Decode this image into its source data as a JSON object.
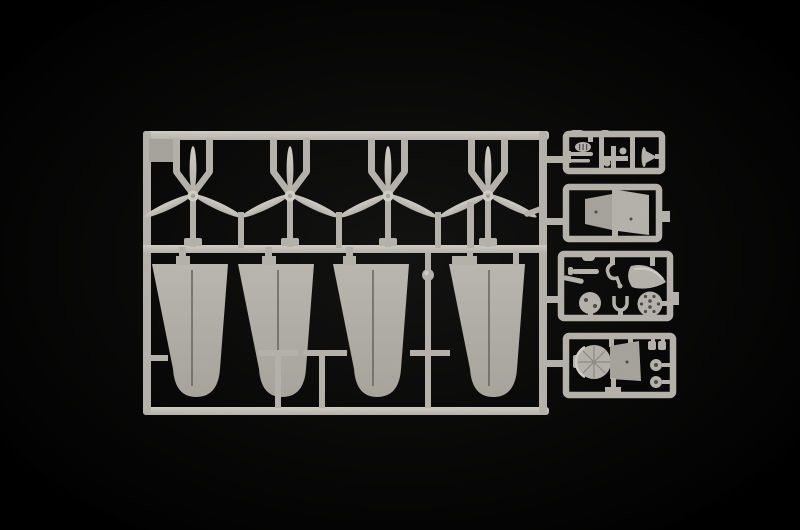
{
  "meta": {
    "subject": "Light grey injection-moulded model aircraft sprue photographed on a black background",
    "text_visible": "none"
  },
  "colors": {
    "background": "#000000",
    "vignette_center": "#121211",
    "plastic_base": "#b2b0a8",
    "plastic_light": "#cdcbc3",
    "plastic_mid": "#a3a199",
    "wing_top": "#b7b5ad",
    "wing_bottom": "#a5a29a",
    "panel_line": "#68665f",
    "detail_dark": "#4c4a45"
  },
  "sprue": {
    "propellers": {
      "count": 4,
      "name": "three-blade propeller"
    },
    "wing_panels": {
      "count": 4,
      "name": "tapered wing panel"
    },
    "detail_boxes": {
      "count": 4,
      "name": "small parts compartment"
    },
    "small_parts": [
      "radiator and gun barrels",
      "governor spinner",
      "cowl flap panels",
      "hook part",
      "spinner cone",
      "engine disc",
      "hub disc",
      "wishbone strut",
      "cowling fan section",
      "wheels"
    ]
  }
}
